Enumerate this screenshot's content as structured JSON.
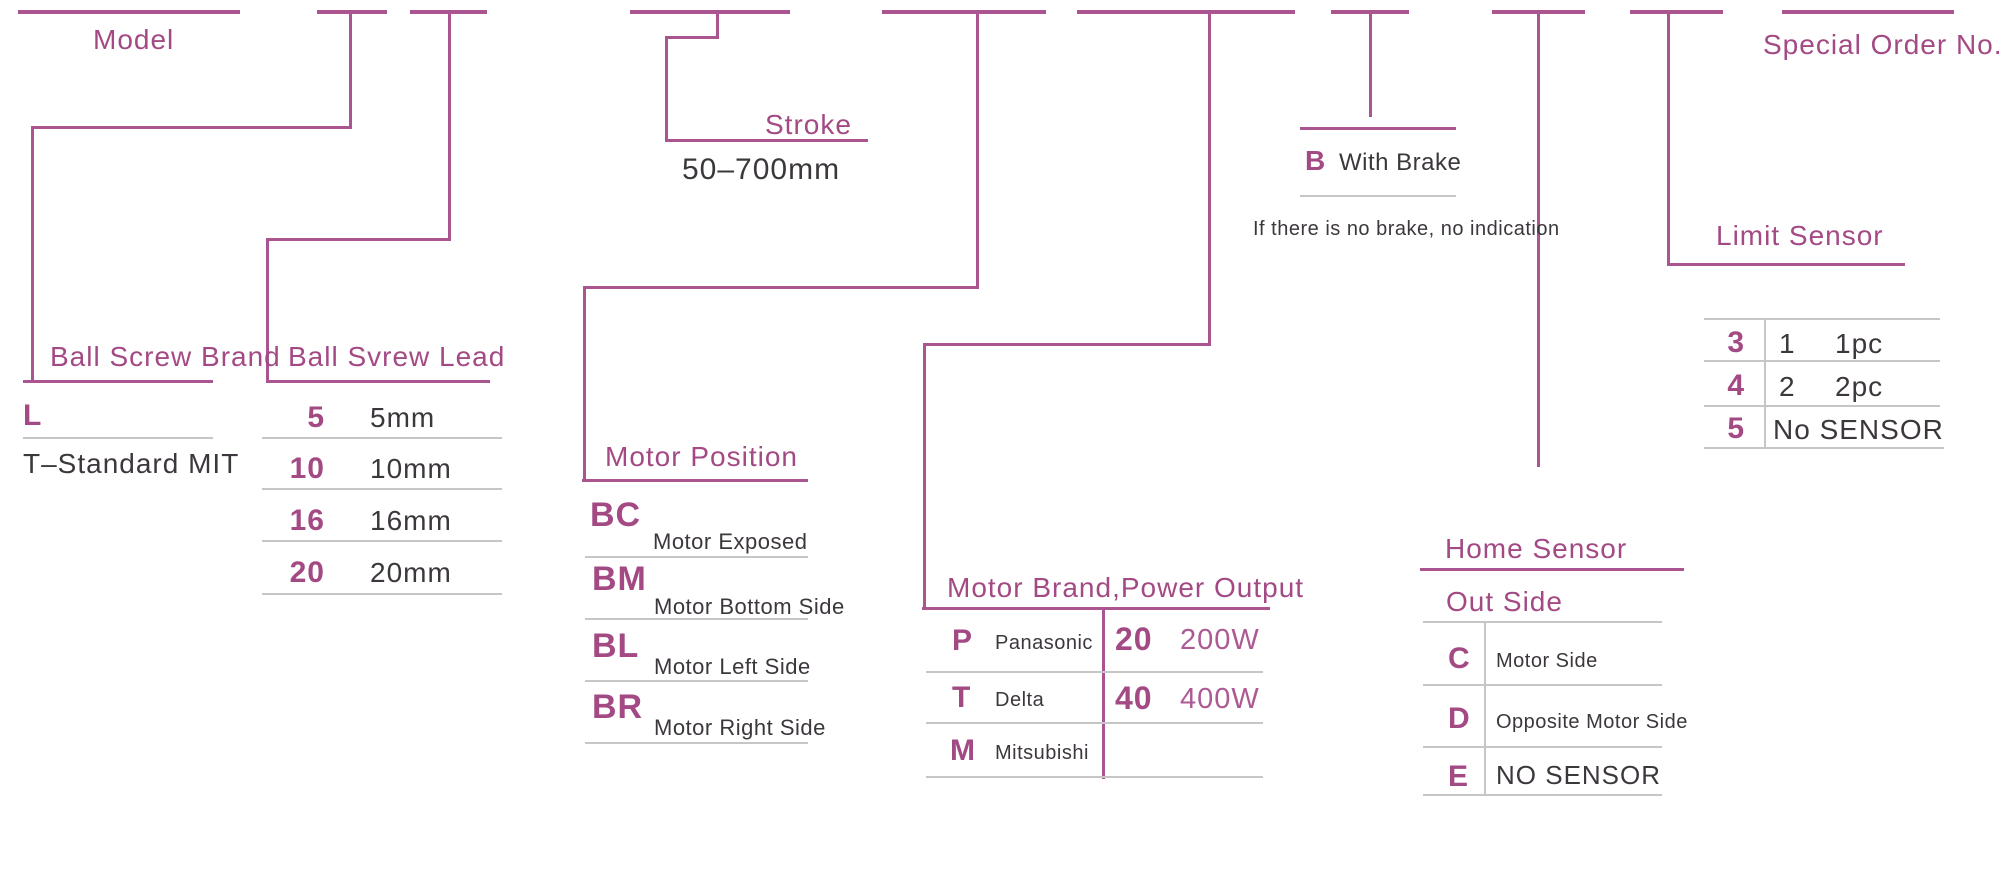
{
  "colors": {
    "accent_text": "#a34a85",
    "accent_line": "#aa5590",
    "divider_gray": "#c6c6c6",
    "text_dark": "#3c373c"
  },
  "model": {
    "label": "Model"
  },
  "ball_screw_brand": {
    "title": "Ball Screw Brand",
    "code": "L",
    "description": "T–Standard MIT"
  },
  "ball_screw_lead": {
    "title": "Ball Svrew Lead",
    "rows": [
      {
        "code": "5",
        "value": "5mm"
      },
      {
        "code": "10",
        "value": "10mm"
      },
      {
        "code": "16",
        "value": "16mm"
      },
      {
        "code": "20",
        "value": "20mm"
      }
    ]
  },
  "stroke": {
    "title": "Stroke",
    "value": "50–700mm"
  },
  "motor_position": {
    "title": "Motor Position",
    "rows": [
      {
        "code": "BC",
        "value": "Motor Exposed"
      },
      {
        "code": "BM",
        "value": "Motor Bottom Side"
      },
      {
        "code": "BL",
        "value": "Motor Left Side"
      },
      {
        "code": "BR",
        "value": "Motor Right Side"
      }
    ]
  },
  "motor_brand_power": {
    "title": "Motor Brand,Power Output",
    "brands": [
      {
        "code": "P",
        "value": "Panasonic"
      },
      {
        "code": "T",
        "value": "Delta"
      },
      {
        "code": "M",
        "value": "Mitsubishi"
      }
    ],
    "powers": [
      {
        "code": "20",
        "value": "200W"
      },
      {
        "code": "40",
        "value": "400W"
      }
    ]
  },
  "brake": {
    "code": "B",
    "label": "With Brake",
    "note": "If there is no brake, no indication"
  },
  "home_sensor": {
    "title": "Home Sensor",
    "subtitle": "Out Side",
    "rows": [
      {
        "code": "C",
        "value": "Motor Side"
      },
      {
        "code": "D",
        "value": "Opposite Motor Side"
      },
      {
        "code": "E",
        "value": "NO SENSOR"
      }
    ]
  },
  "limit_sensor": {
    "title": "Limit Sensor",
    "rows": [
      {
        "code": "3",
        "qty": "1",
        "value": "1pc"
      },
      {
        "code": "4",
        "qty": "2",
        "value": "2pc"
      },
      {
        "code": "5",
        "qty": "",
        "value": "No SENSOR"
      }
    ]
  },
  "special_order": {
    "label": "Special Order No."
  }
}
